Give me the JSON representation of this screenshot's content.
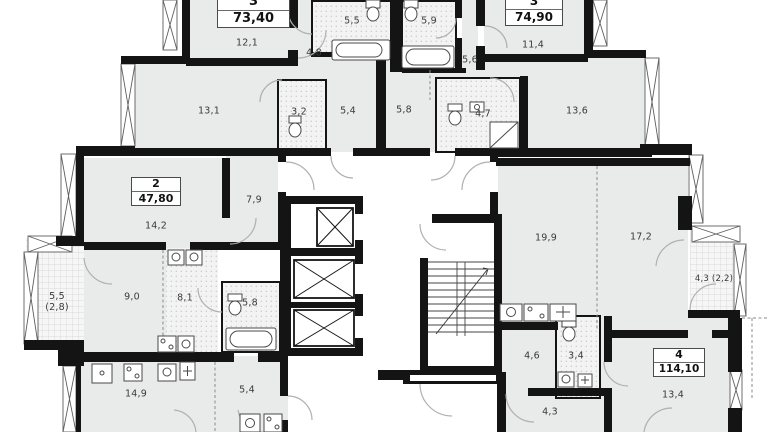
{
  "meta": {
    "type": "residential-floor-plan"
  },
  "colors": {
    "wall": "#141414",
    "room_fill": "#e9eaea",
    "wet_room_fill": "#f3f3f3",
    "door_arc": "#b0b0b0",
    "label_text": "#3a3a3a"
  },
  "apartments": [
    {
      "rooms_count": "3",
      "area": "73,40"
    },
    {
      "rooms_count": "3",
      "area": "74,90"
    },
    {
      "rooms_count": "2",
      "area": "47,80"
    },
    {
      "rooms_count": "4",
      "area": "114,10"
    }
  ],
  "room_labels": [
    {
      "text": "12,1"
    },
    {
      "text": "5,5"
    },
    {
      "text": "5,9"
    },
    {
      "text": "4,8"
    },
    {
      "text": "11,4"
    },
    {
      "text": "5,6"
    },
    {
      "text": "13,1"
    },
    {
      "text": "3,2"
    },
    {
      "text": "5,4"
    },
    {
      "text": "5,8"
    },
    {
      "text": "4,7"
    },
    {
      "text": "13,6"
    },
    {
      "text": "14,2"
    },
    {
      "text": "7,9"
    },
    {
      "text": "19,9"
    },
    {
      "text": "17,2"
    },
    {
      "text": "5,5\n(2,8)"
    },
    {
      "text": "9,0"
    },
    {
      "text": "8,1"
    },
    {
      "text": "5,8"
    },
    {
      "text": "4,3 (2,2)"
    },
    {
      "text": "4,6"
    },
    {
      "text": "3,4"
    },
    {
      "text": "14,9"
    },
    {
      "text": "5,4"
    },
    {
      "text": "4,3"
    },
    {
      "text": "13,4"
    }
  ]
}
